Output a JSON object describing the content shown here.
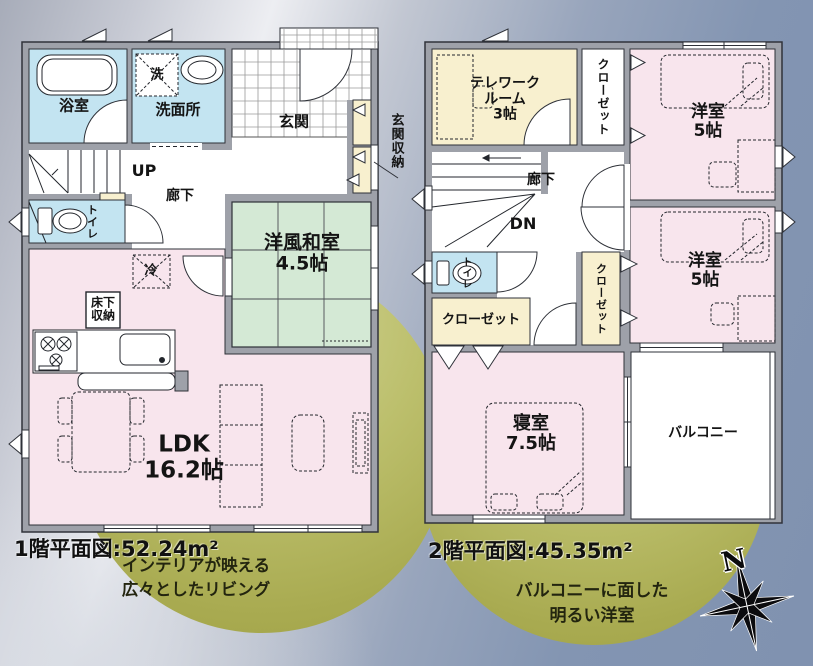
{
  "floor1": {
    "caption": "1階平面図:52.24m²",
    "callout": [
      "インテリアが映える",
      "広々としたリビング"
    ],
    "rooms": {
      "bath": "浴室",
      "washer": "洗",
      "washroom": "洗面所",
      "entrance": "玄関",
      "entrance_storage": "玄関収納",
      "stairs_up": "UP",
      "hallway": "廊下",
      "toilet": "トイレ",
      "fridge": "冷",
      "underfloor_storage": [
        "床下",
        "収納"
      ],
      "japanese_room": [
        "洋風和室",
        "4.5帖"
      ],
      "ldk": [
        "LDK",
        "16.2帖"
      ]
    }
  },
  "floor2": {
    "caption": "2階平面図:45.35m²",
    "callout": [
      "バルコニーに面した",
      "明るい洋室"
    ],
    "rooms": {
      "telework": [
        "テレワーク",
        "ルーム",
        "3帖"
      ],
      "closet_top": "クローゼット",
      "closet_mid": "クローゼット",
      "closet_left": "クローゼット",
      "bedroom5_top": [
        "洋室",
        "5帖"
      ],
      "bedroom5_bottom": [
        "洋室",
        "5帖"
      ],
      "hallway": "廊下",
      "stairs_down": "DN",
      "toilet": "トイレ",
      "main_bedroom": [
        "寝室",
        "7.5帖"
      ],
      "balcony": "バルコニー"
    }
  },
  "compass": {
    "north": "N"
  },
  "palette": {
    "room_pink": "#f8e5ed",
    "room_blue": "#c3e4f1",
    "room_green": "#d4e9d5",
    "room_cream": "#f8f0cf",
    "wall_gray": "#9ea1a9",
    "callout_olive": "#b0b258",
    "background_blue": "#8496b3"
  }
}
